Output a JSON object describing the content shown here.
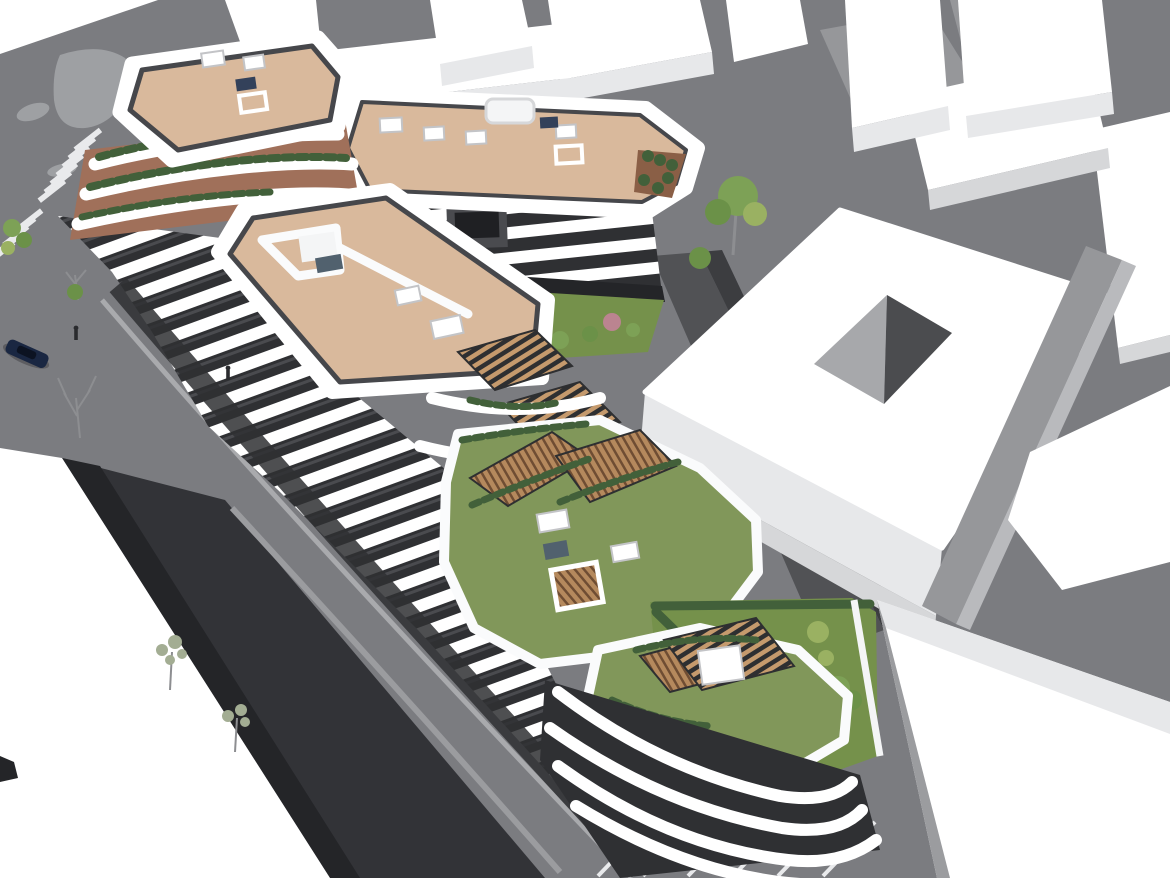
{
  "scene": {
    "type": "architectural-3d-aerial-render",
    "description": "Aerial 3D architectural visualization of a curved white residential apartment complex with beige roof decks, skylights, planted terraces, green roofs, timber pergolas, surrounding grey streets, zebra crossings, a parked dark car, pedestrians and plain white context massing buildings (one with a square courtyard void).",
    "counts": {
      "zebra_crossings": 2,
      "parking_bays": 6,
      "cars": 2,
      "pedestrians": 2,
      "trees": 7
    }
  },
  "palette": {
    "white": "#ffffff",
    "offWhite": "#f4f5f6",
    "parapet": "#fafbfc",
    "faceLight": "#e7e8ea",
    "faceMid": "#d6d7d9",
    "faceDark": "#c3c4c7",
    "road": "#7b7c80",
    "island": "#9ea0a3",
    "curb": "#a9aaad",
    "embankment": "#323337",
    "embankEdge": "#242528",
    "facadeDark": "#2f3033",
    "facadeMid": "#4a4b4f",
    "fascia": "#46474b",
    "glass": "#1f2023",
    "glassPanel": "#51616e",
    "panelBlue": "#33415a",
    "tan": "#d9b99c",
    "terracotta": "#a0705a",
    "soil": "#8a5f46",
    "greenRoof": "#81975a",
    "grass": "#75914b",
    "hedge": "#42603a",
    "foliage": "#7da156",
    "foliageDark": "#6b9148",
    "foliageLight": "#9ab162",
    "olive": "#a3ad93",
    "pink": "#bb8490",
    "woodSlat": "#c59a6d",
    "woodDeck": "#b5895d",
    "woodDark": "#6f4d33",
    "slatGap": "#2e2f31",
    "holeDark": "#4b4c4f",
    "holeLight": "#a7a8ab",
    "strip": "#96979a",
    "stripLight": "#b9babd",
    "shadowGrey": "#9b9c9f",
    "alley": "#515255",
    "alleyDark": "#3c3d40",
    "stripePaint": "#e9eaec",
    "carBody": "#1a2742",
    "carGlass": "#0c1322",
    "figure": "#2a2b2e",
    "treeBare": "#8d8e91"
  }
}
